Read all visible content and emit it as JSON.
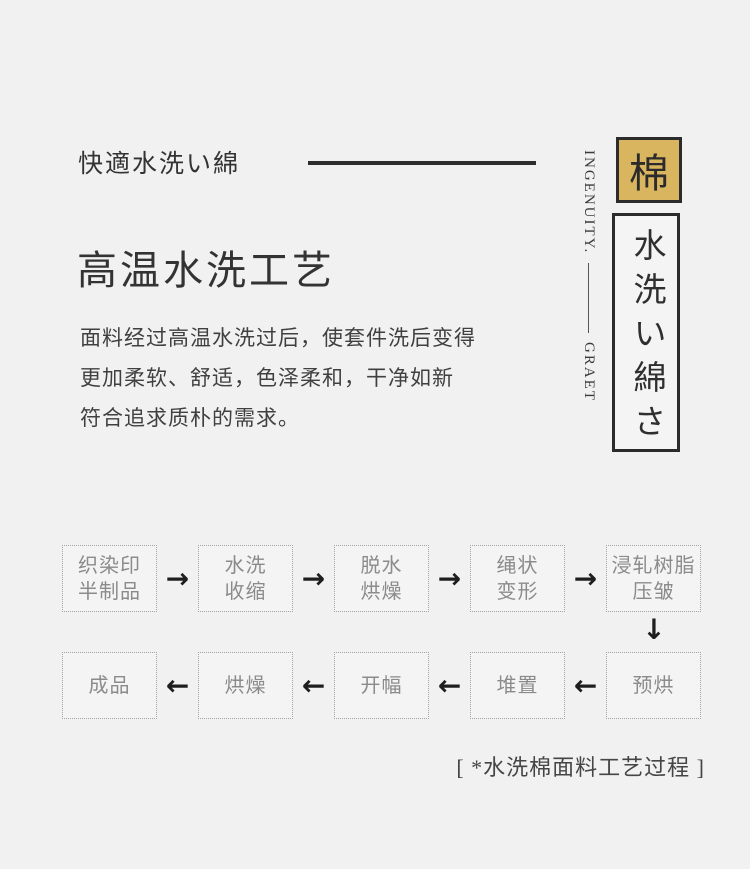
{
  "header": {
    "subtitle": "快適水洗い綿",
    "title": "高温水洗工艺",
    "paragraph": "面料经过高温水洗过后，使套件洗后变得\n更加柔软、舒适，色泽柔和，干净如新\n符合追求质朴的需求。"
  },
  "side": {
    "motto_top": "INGENUITY.",
    "motto_bottom": "GRAET",
    "badge_char": "棉",
    "badge_color": "#d9b55f",
    "vertical_label": "水洗い綿さ"
  },
  "flow": {
    "arrow_right": "→",
    "arrow_left": "←",
    "arrow_down": "↓",
    "row1": [
      {
        "label": "织染印\n半制品"
      },
      {
        "label": "水洗\n收缩"
      },
      {
        "label": "脱水\n烘燥"
      },
      {
        "label": "绳状\n变形"
      },
      {
        "label": "浸轧树脂\n压皱"
      }
    ],
    "row2": [
      {
        "label": "成品"
      },
      {
        "label": "烘燥"
      },
      {
        "label": "开幅"
      },
      {
        "label": "堆置"
      },
      {
        "label": "预烘"
      }
    ],
    "caption": "[ *水洗棉面料工艺过程 ]"
  }
}
